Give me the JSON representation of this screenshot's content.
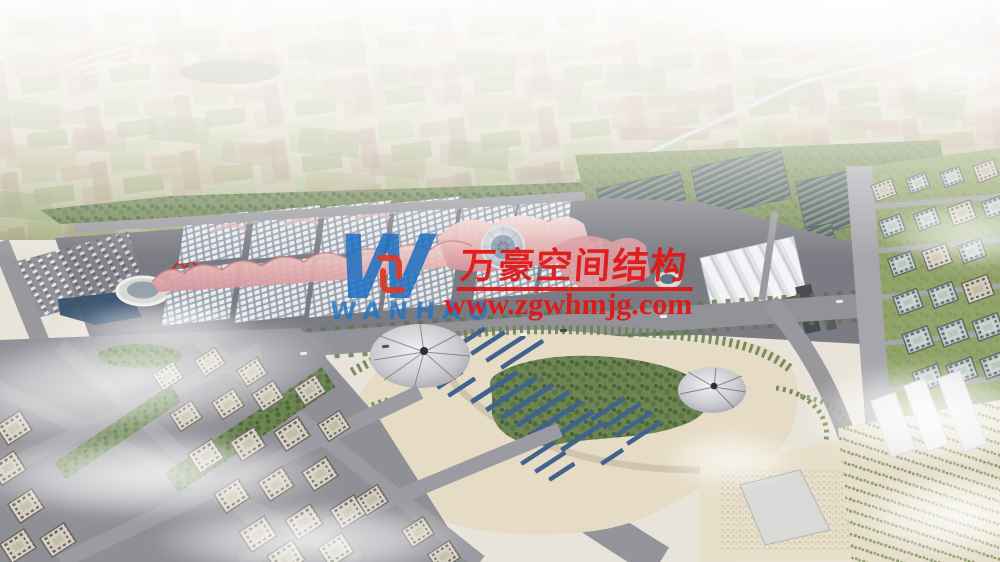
{
  "watermark": {
    "logo_mark": "W",
    "logo_text": "WANHAO",
    "company_name_cn": "万豪空间结构",
    "website": "www.zgwhmjg.com",
    "colors": {
      "red": "#e41414",
      "blue": "#1d6fc2"
    }
  },
  "scene": {
    "type": "aerial architectural rendering",
    "regions": [
      "hazy farmland horizon",
      "canal",
      "solar panel farms",
      "exhibition complex with gridshell halls and pink wave roofs",
      "central glass dome hub",
      "white pleated exhibition hall",
      "round stadium and pond",
      "central park with membrane cones and solar strips",
      "residential city blocks",
      "roads and boulevards",
      "clouds"
    ]
  }
}
